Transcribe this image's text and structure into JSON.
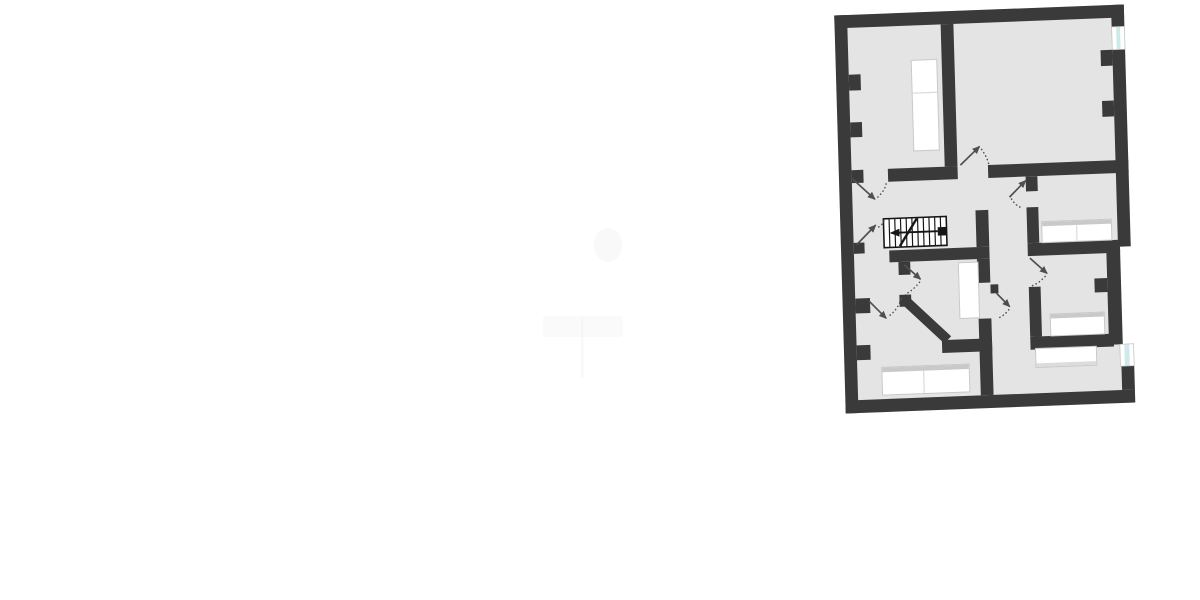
{
  "scene": {
    "type": "floor-plan",
    "description": "Rotated architectural floor plan of an upper storey, drawn in dark grey walls on a light grey floor, placed on a white page",
    "background": "#ffffff"
  },
  "palette": {
    "background": "#ffffff",
    "wall": "#3a3a3a",
    "floor": "#e4e4e4",
    "window_tint": "#cfe9ea",
    "window_pane": "#ffffff",
    "furniture": "#ffffff",
    "furniture_edge": "#c9c9c9",
    "divider": "#dadada",
    "door_arrow": "#4f4f4f",
    "stair_ink": "#161616",
    "smudge": "#f4f4f4"
  },
  "elements": {
    "rooms_count": 6,
    "windows": [
      "right-wall-top-window",
      "right-wall-bottom-window"
    ],
    "furniture": [
      "wardrobe",
      "double-bed-small",
      "bathtub",
      "single-bed",
      "double-bed-large",
      "desk"
    ],
    "stairs": {
      "treads": 10,
      "direction_arrow": "left",
      "has_break_line": true,
      "has_end-post": true
    },
    "door_swings_count": 8,
    "wall_pilaster_stubs_count": 9
  }
}
